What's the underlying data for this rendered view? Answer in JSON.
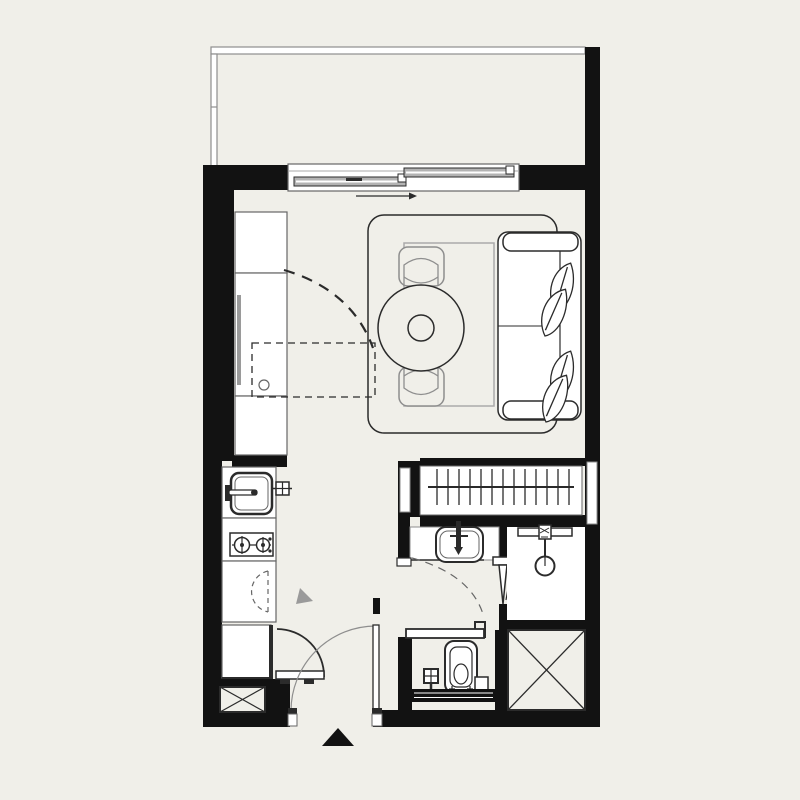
{
  "canvas": {
    "width": 800,
    "height": 800
  },
  "colors": {
    "background": "#f0efe9",
    "wall": "#121212",
    "fixture-fill": "#ffffff",
    "line-dark": "#2b2b2b",
    "line-mid": "#666666",
    "line-gray": "#8e8e8e",
    "line-light": "#aaaaaa",
    "panel-gray": "#b3b3b3",
    "arrow-gray": "#9a9a9a"
  },
  "plan": {
    "type": "studio-apartment-floor-plan",
    "rooms": [
      {
        "name": "balcony",
        "fixtures": [
          "perimeter-railing",
          "sliding-glass-door",
          "slide-direction-arrow"
        ]
      },
      {
        "name": "living-dining",
        "fixtures": [
          "area-rug",
          "dining-table",
          "round-table",
          "dining-chair-top",
          "dining-chair-bottom",
          "two-seat-sofa",
          "leaf-pillows",
          "overhead-unit-dashed-outline",
          "cabinet-door-swing-dashed"
        ]
      },
      {
        "name": "kitchen",
        "fixtures": [
          "tall-cabinet",
          "refrigerator",
          "base-cabinet",
          "kitchen-sink",
          "faucet",
          "power-outlet",
          "two-burner-cooktop",
          "pull-out-unit-with-arrow",
          "lower-cabinet",
          "closet-door-with-swing",
          "service-shaft-small"
        ]
      },
      {
        "name": "hall-wardrobe",
        "fixtures": [
          "wardrobe-with-hanger-rail",
          "wall-vent-slot"
        ]
      },
      {
        "name": "bathroom",
        "fixtures": [
          "vanity-counter",
          "wash-basin",
          "basin-faucet",
          "door-swing-dashed",
          "bathroom-door",
          "shower-mixer-bar",
          "shower-head",
          "towel-shelf",
          "toilet",
          "floor-drain",
          "threshold-grate",
          "service-shaft-large"
        ]
      },
      {
        "name": "entry",
        "fixtures": [
          "entry-door-leaf",
          "entry-door-swing",
          "door-jambs",
          "entrance-marker-triangle"
        ]
      }
    ],
    "wardrobe": {
      "hanger_count": 13
    },
    "markers": {
      "entrance": "triangle-up",
      "balcony-door-slide": "arrow-right"
    }
  }
}
